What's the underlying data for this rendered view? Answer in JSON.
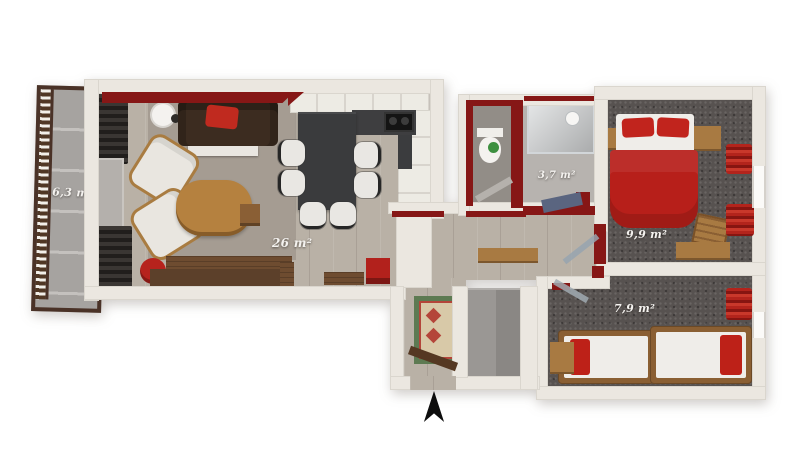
{
  "title": "apartment-3d-floor-plan",
  "rooms": {
    "balcony": {
      "area_label": "6,3 m²"
    },
    "living_kitchen": {
      "area_label": "26 m²"
    },
    "bathroom": {
      "area_label": "3,7 m²"
    },
    "bedroom_main": {
      "area_label": "9,9 m²"
    },
    "bedroom_second": {
      "area_label": "7,9 m²"
    }
  },
  "icons": {
    "north_arrow": "▲"
  },
  "colors": {
    "background": "#ffffff",
    "wall": "#ebe7e0",
    "accent_red_wall": "#861716",
    "wood_floor": "#b9b1a6",
    "living_rug": "#a59c92",
    "carpet_dark": "#575250",
    "balcony_rail_brown": "#4a3227",
    "furniture_red": "#bd2118",
    "furniture_wood": "#a87a42",
    "sofa_brown": "#3c2c20",
    "table_charcoal": "#3a3b3d",
    "mat_blue": "#5a6580",
    "toilet_green": "#3e9040"
  }
}
